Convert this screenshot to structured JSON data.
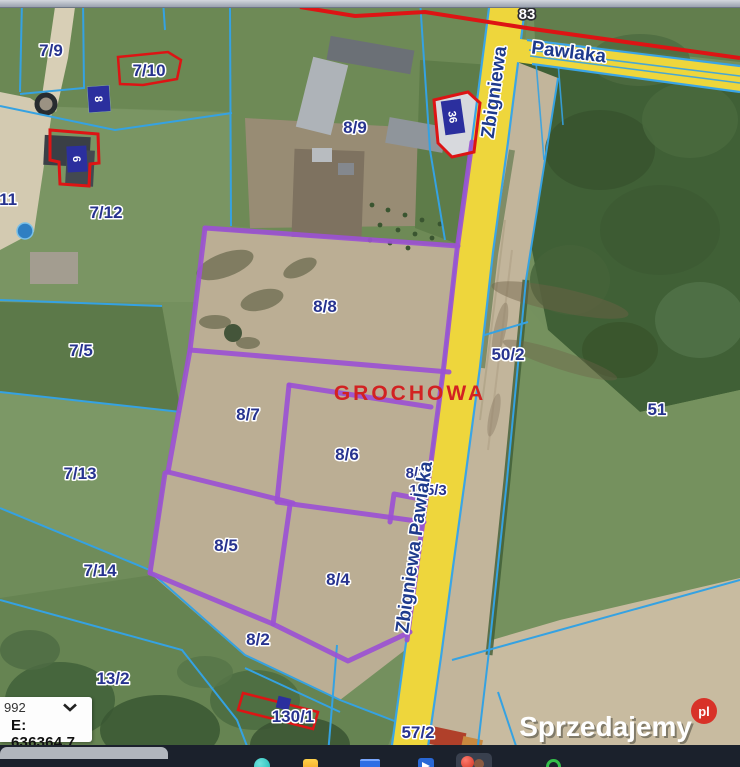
{
  "map": {
    "labels": {
      "p7_9": "7/9",
      "p7_10": "7/10",
      "p7_11": "7/11",
      "p7_12": "7/12",
      "p7_5": "7/5",
      "p7_13": "7/13",
      "p7_14": "7/14",
      "p13_2": "13/2",
      "p8_9": "8/9",
      "p8_8": "8/8",
      "p8_7": "8/7",
      "p8_6": "8/6",
      "p8_5": "8/5",
      "p8_4": "8/4",
      "p8_2": "8/2",
      "p8_1": "8/1",
      "p135_3": "135/3",
      "p50_2": "50/2",
      "p51": "51",
      "p130_1": "130/1",
      "p57_2": "57/2"
    },
    "road_number": "83",
    "street": {
      "vertical_segment": "Zbigniewa",
      "horizontal_segment": "Pawlaka",
      "full_name": "Zbigniewa Pawlaka"
    },
    "place_name": "GROCHOWA",
    "building_numbers": {
      "b36": "36",
      "b8": "8",
      "b6": "6"
    },
    "colors": {
      "road-yellow": "#eed63c",
      "road-edge-cyan": "#3aa5e6",
      "parcel-cyan": "#35a2e2",
      "boundary-purple": "#9b51d3",
      "outline-red": "#dd1414",
      "label-blue": "#27338f",
      "place-red": "#d22222",
      "bldg-label-blue": "#2b2f9e"
    }
  },
  "coords_panel": {
    "scale_value": "992",
    "easting": "E: 636364.7"
  },
  "watermark": {
    "brand": "Sprzedajemy",
    "badge": "pl"
  }
}
